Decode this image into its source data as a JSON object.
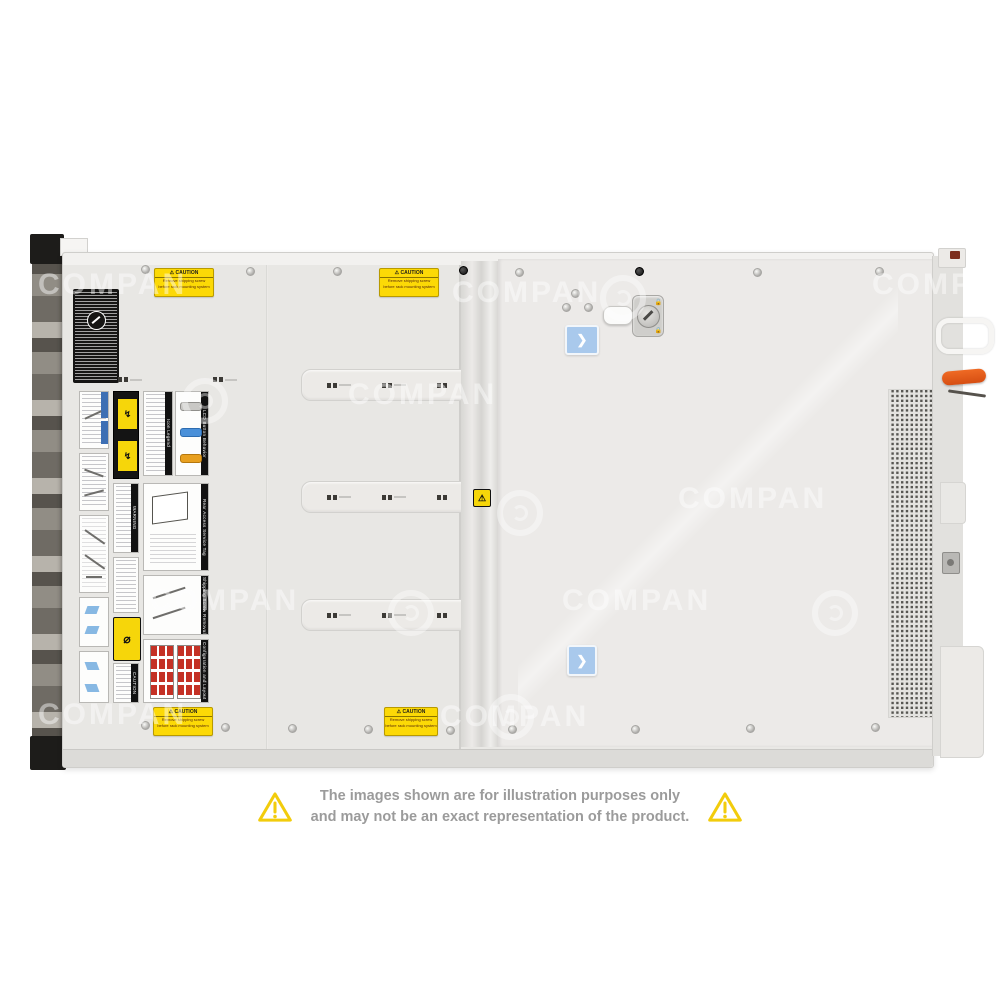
{
  "watermark": {
    "text": "COMPAN"
  },
  "disclaimer": {
    "line1": "The images shown are for illustration purposes only",
    "line2": "and may not be an exact representation of the product."
  },
  "server": {
    "caution": {
      "title": "⚠ CAUTION",
      "line1": "Remove shipping screw",
      "line2": "before rack mounting system"
    },
    "labels": {
      "icon_legend": "Icon Legend",
      "lcd_button": "LCD Button Behavior",
      "rear_access": "Rear Access Service Tag",
      "shipping_screw": "Shipping Screw Removal",
      "config_layout": "Configuration and Layout",
      "warning": "WARNING",
      "caution": "CAUTION"
    },
    "latch": {
      "chevron": "❯"
    },
    "colors": {
      "chassis": "#e9e8e5",
      "caution_yellow": "#fcd906",
      "blue_sticker": "#a9c9ec",
      "orange_lever": "#e8591c",
      "drive_red": "#c43125"
    }
  }
}
